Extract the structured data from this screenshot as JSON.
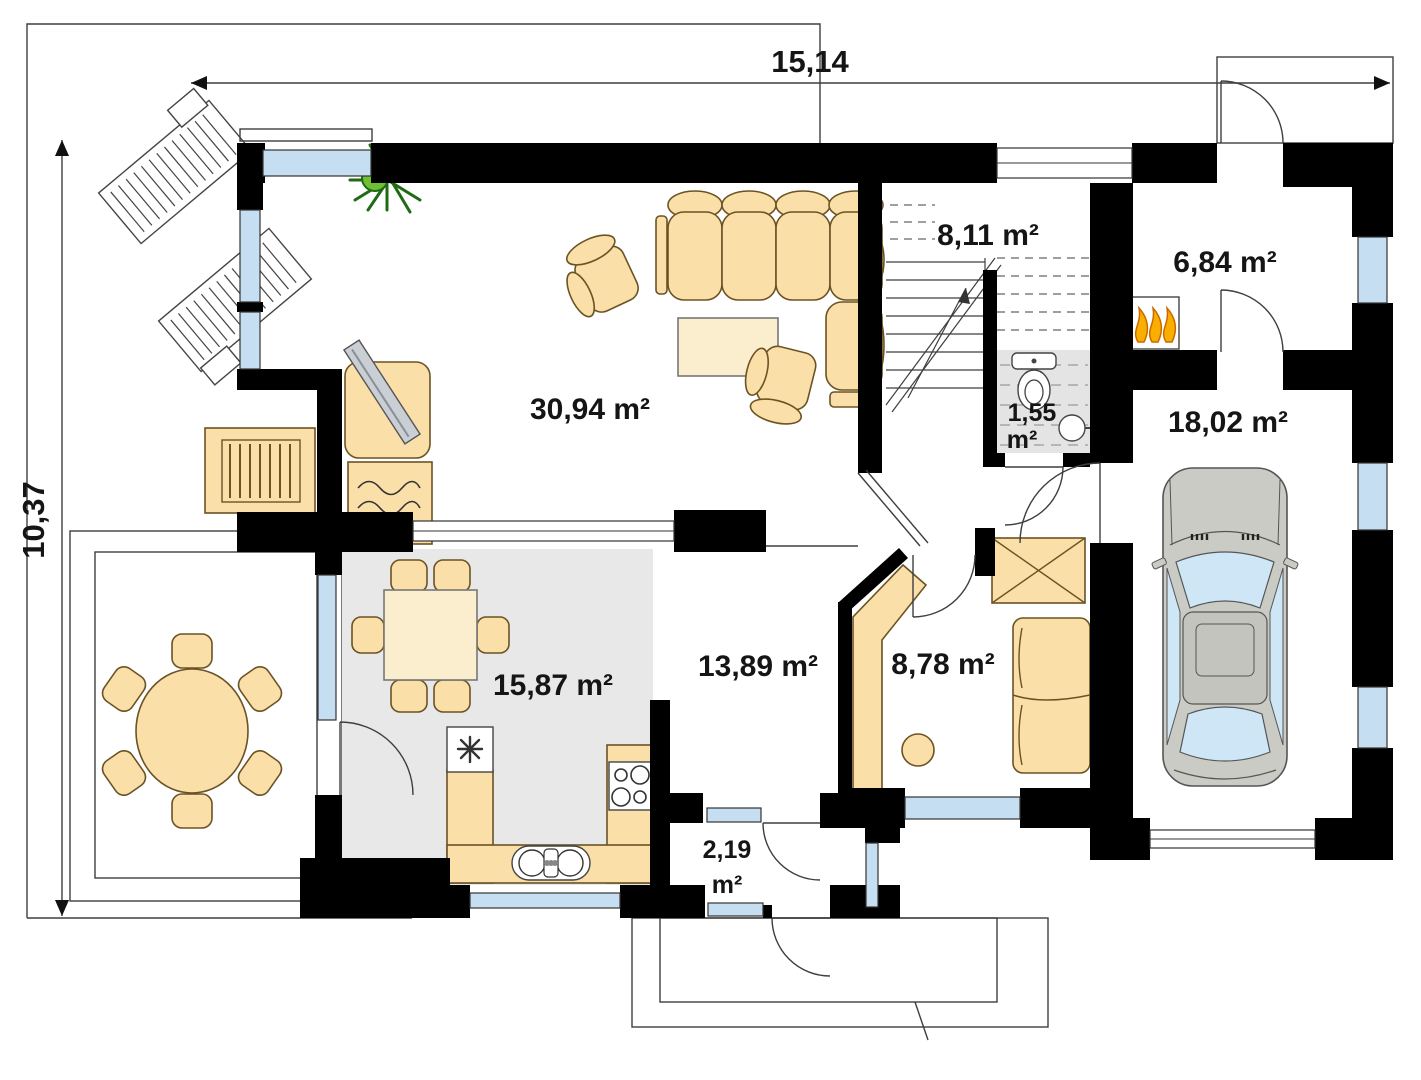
{
  "plan": {
    "title": "House ground-floor plan",
    "dimensions": {
      "width_m": "15,14",
      "depth_m": "10,37"
    },
    "rooms": {
      "living_room": {
        "name": "living room",
        "area": "30,94 m²"
      },
      "stair_hall": {
        "name": "stair hall",
        "area": "8,11 m²"
      },
      "boiler_room": {
        "name": "boiler room",
        "area": "6,84 m²"
      },
      "wc": {
        "name": "wc",
        "area_value": "1,55",
        "area_unit": "m²"
      },
      "garage": {
        "name": "garage",
        "area": "18,02 m²"
      },
      "kitchen": {
        "name": "kitchen",
        "area": "15,87 m²"
      },
      "hall": {
        "name": "hall",
        "area": "13,89 m²"
      },
      "office": {
        "name": "office",
        "area": "8,78 m²"
      },
      "vestibule": {
        "name": "vestibule",
        "area_value": "2,19",
        "area_unit": "m²"
      }
    },
    "furniture_icons": [
      "sun-lounger",
      "corner-sofa",
      "armchair",
      "coffee-table",
      "tv",
      "fireplace",
      "garden-bench",
      "plant",
      "round-dining-table",
      "square-dining-table",
      "chair",
      "fridge",
      "stove",
      "kitchen-sink",
      "toilet",
      "washbasin",
      "staircase",
      "furnace",
      "wardrobe",
      "desk",
      "stool",
      "office-sofa",
      "car"
    ],
    "colors": {
      "wall": "#000000",
      "furniture_beige": "#FBDFA9",
      "furniture_light": "#FBEECE",
      "kitchen_floor": "#E8E8E8",
      "window_blue": "#C6DEF1",
      "flame_orange": "#F5A623",
      "plant_green": "#4CAF2A",
      "car_body": "#CBCBC5",
      "car_glass": "#CFE6F7"
    }
  }
}
